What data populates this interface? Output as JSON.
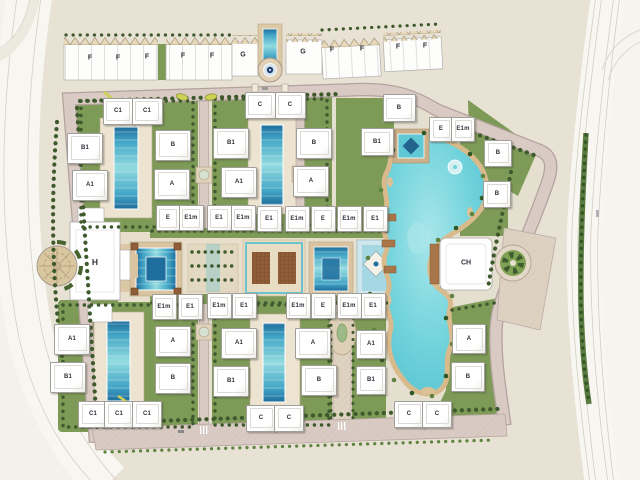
{
  "buildings": [
    {
      "t": "F",
      "x": 90,
      "y": 58,
      "box": false,
      "fs": 7
    },
    {
      "t": "F",
      "x": 118,
      "y": 58,
      "box": false,
      "fs": 7
    },
    {
      "t": "F",
      "x": 147,
      "y": 57,
      "box": false,
      "fs": 7
    },
    {
      "t": "F",
      "x": 183,
      "y": 56,
      "box": false,
      "fs": 7
    },
    {
      "t": "F",
      "x": 212,
      "y": 56,
      "box": false,
      "fs": 7
    },
    {
      "t": "G",
      "x": 243,
      "y": 55,
      "box": false,
      "fs": 7
    },
    {
      "t": "G",
      "x": 303,
      "y": 52,
      "box": false,
      "fs": 7
    },
    {
      "t": "F",
      "x": 332,
      "y": 50,
      "box": false,
      "fs": 7
    },
    {
      "t": "F",
      "x": 362,
      "y": 49,
      "box": false,
      "fs": 7
    },
    {
      "t": "F",
      "x": 398,
      "y": 47,
      "box": false,
      "fs": 7
    },
    {
      "t": "F",
      "x": 425,
      "y": 46,
      "box": false,
      "fs": 7
    },
    {
      "t": "H",
      "x": 95,
      "y": 262,
      "box": false,
      "fs": 8.5
    },
    {
      "t": "CH",
      "x": 466,
      "y": 263,
      "box": false,
      "fs": 7
    },
    {
      "t": "C1",
      "x": 117,
      "y": 110,
      "box": true,
      "w": 29,
      "h": 25
    },
    {
      "t": "C1",
      "x": 146,
      "y": 110,
      "box": true,
      "w": 29,
      "h": 25
    },
    {
      "t": "B1",
      "x": 84,
      "y": 147,
      "box": true,
      "w": 34,
      "h": 29
    },
    {
      "t": "B",
      "x": 172,
      "y": 144,
      "box": true,
      "w": 34,
      "h": 29
    },
    {
      "t": "A1",
      "x": 89,
      "y": 184,
      "box": true,
      "w": 34,
      "h": 29
    },
    {
      "t": "A",
      "x": 171,
      "y": 183,
      "box": true,
      "w": 34,
      "h": 29
    },
    {
      "t": "C",
      "x": 259,
      "y": 104,
      "box": true,
      "w": 29,
      "h": 25
    },
    {
      "t": "C",
      "x": 289,
      "y": 104,
      "box": true,
      "w": 29,
      "h": 25
    },
    {
      "t": "B1",
      "x": 230,
      "y": 142,
      "box": true,
      "w": 34,
      "h": 29
    },
    {
      "t": "B",
      "x": 313,
      "y": 142,
      "box": true,
      "w": 34,
      "h": 29
    },
    {
      "t": "A1",
      "x": 238,
      "y": 181,
      "box": true,
      "w": 34,
      "h": 29
    },
    {
      "t": "A",
      "x": 310,
      "y": 180,
      "box": true,
      "w": 34,
      "h": 29
    },
    {
      "t": "B",
      "x": 398,
      "y": 107,
      "box": true,
      "w": 31,
      "h": 26
    },
    {
      "t": "B1",
      "x": 376,
      "y": 141,
      "box": true,
      "w": 31,
      "h": 26
    },
    {
      "t": "E",
      "x": 440,
      "y": 128,
      "box": true,
      "w": 22,
      "h": 23
    },
    {
      "t": "E1m",
      "x": 462,
      "y": 128,
      "box": true,
      "w": 22,
      "h": 23
    },
    {
      "t": "B",
      "x": 497,
      "y": 152,
      "box": true,
      "w": 26,
      "h": 25
    },
    {
      "t": "B",
      "x": 496,
      "y": 193,
      "box": true,
      "w": 26,
      "h": 25
    },
    {
      "t": "E",
      "x": 167,
      "y": 217,
      "box": true,
      "w": 23,
      "h": 24
    },
    {
      "t": "E1m",
      "x": 190,
      "y": 217,
      "box": true,
      "w": 23,
      "h": 24
    },
    {
      "t": "E1",
      "x": 218,
      "y": 217,
      "box": true,
      "w": 23,
      "h": 24
    },
    {
      "t": "E1m",
      "x": 242,
      "y": 217,
      "box": true,
      "w": 23,
      "h": 24
    },
    {
      "t": "E1",
      "x": 268,
      "y": 218,
      "box": true,
      "w": 23,
      "h": 24
    },
    {
      "t": "E1m",
      "x": 296,
      "y": 218,
      "box": true,
      "w": 23,
      "h": 24
    },
    {
      "t": "E",
      "x": 322,
      "y": 218,
      "box": true,
      "w": 23,
      "h": 24
    },
    {
      "t": "E1m",
      "x": 348,
      "y": 218,
      "box": true,
      "w": 23,
      "h": 24
    },
    {
      "t": "E1",
      "x": 374,
      "y": 218,
      "box": true,
      "w": 23,
      "h": 24
    },
    {
      "t": "E1m",
      "x": 163,
      "y": 306,
      "box": true,
      "w": 23,
      "h": 24
    },
    {
      "t": "E1",
      "x": 189,
      "y": 306,
      "box": true,
      "w": 23,
      "h": 24
    },
    {
      "t": "E1m",
      "x": 218,
      "y": 305,
      "box": true,
      "w": 23,
      "h": 24
    },
    {
      "t": "E1",
      "x": 243,
      "y": 305,
      "box": true,
      "w": 23,
      "h": 24
    },
    {
      "t": "E1m",
      "x": 297,
      "y": 305,
      "box": true,
      "w": 23,
      "h": 24
    },
    {
      "t": "E",
      "x": 322,
      "y": 305,
      "box": true,
      "w": 23,
      "h": 24
    },
    {
      "t": "E1m",
      "x": 348,
      "y": 305,
      "box": true,
      "w": 23,
      "h": 24
    },
    {
      "t": "E1",
      "x": 372,
      "y": 305,
      "box": true,
      "w": 23,
      "h": 24
    },
    {
      "t": "A1",
      "x": 71,
      "y": 338,
      "box": true,
      "w": 34,
      "h": 29
    },
    {
      "t": "A",
      "x": 172,
      "y": 340,
      "box": true,
      "w": 34,
      "h": 29
    },
    {
      "t": "B1",
      "x": 67,
      "y": 376,
      "box": true,
      "w": 34,
      "h": 29
    },
    {
      "t": "B",
      "x": 172,
      "y": 377,
      "box": true,
      "w": 34,
      "h": 29
    },
    {
      "t": "C1",
      "x": 92,
      "y": 413,
      "box": true,
      "w": 28,
      "h": 25
    },
    {
      "t": "C1",
      "x": 118,
      "y": 413,
      "box": true,
      "w": 28,
      "h": 25
    },
    {
      "t": "C1",
      "x": 146,
      "y": 413,
      "box": true,
      "w": 28,
      "h": 25
    },
    {
      "t": "A1",
      "x": 238,
      "y": 342,
      "box": true,
      "w": 34,
      "h": 29
    },
    {
      "t": "A",
      "x": 312,
      "y": 342,
      "box": true,
      "w": 34,
      "h": 29
    },
    {
      "t": "B1",
      "x": 230,
      "y": 380,
      "box": true,
      "w": 34,
      "h": 29
    },
    {
      "t": "B",
      "x": 318,
      "y": 379,
      "box": true,
      "w": 34,
      "h": 29
    },
    {
      "t": "C",
      "x": 260,
      "y": 417,
      "box": true,
      "w": 28,
      "h": 25
    },
    {
      "t": "C",
      "x": 288,
      "y": 417,
      "box": true,
      "w": 28,
      "h": 25
    },
    {
      "t": "A1",
      "x": 370,
      "y": 343,
      "box": true,
      "w": 28,
      "h": 27
    },
    {
      "t": "B1",
      "x": 370,
      "y": 379,
      "box": true,
      "w": 28,
      "h": 27
    },
    {
      "t": "A",
      "x": 468,
      "y": 338,
      "box": true,
      "w": 32,
      "h": 28
    },
    {
      "t": "B",
      "x": 467,
      "y": 376,
      "box": true,
      "w": 32,
      "h": 28
    },
    {
      "t": "C",
      "x": 408,
      "y": 413,
      "box": true,
      "w": 28,
      "h": 25
    },
    {
      "t": "C",
      "x": 436,
      "y": 413,
      "box": true,
      "w": 28,
      "h": 25
    }
  ],
  "colors": {
    "land": "#e8e2d5",
    "compound": "#e5dfcf",
    "green": "#7d9b57",
    "tree": "#3e5a2d",
    "road": "#d9cac4",
    "road_edge": "#b7a6a0",
    "promenade": "#dbd0bf",
    "highway": "#f8f6f1",
    "lane_line": "#cfc9bc",
    "water": "#6fd2db",
    "water_dark": "#1f6f9e",
    "sand": "#d9ba8c",
    "deck": "#d9c3a0",
    "plaza": "#e3d6bd",
    "pergola": "#8f5d37",
    "building": "#ffffff",
    "building_edge": "#a9a7a3",
    "gable": "#e7d9ba",
    "label": "#2e2e38",
    "accent_yellow": "#ccd155"
  }
}
